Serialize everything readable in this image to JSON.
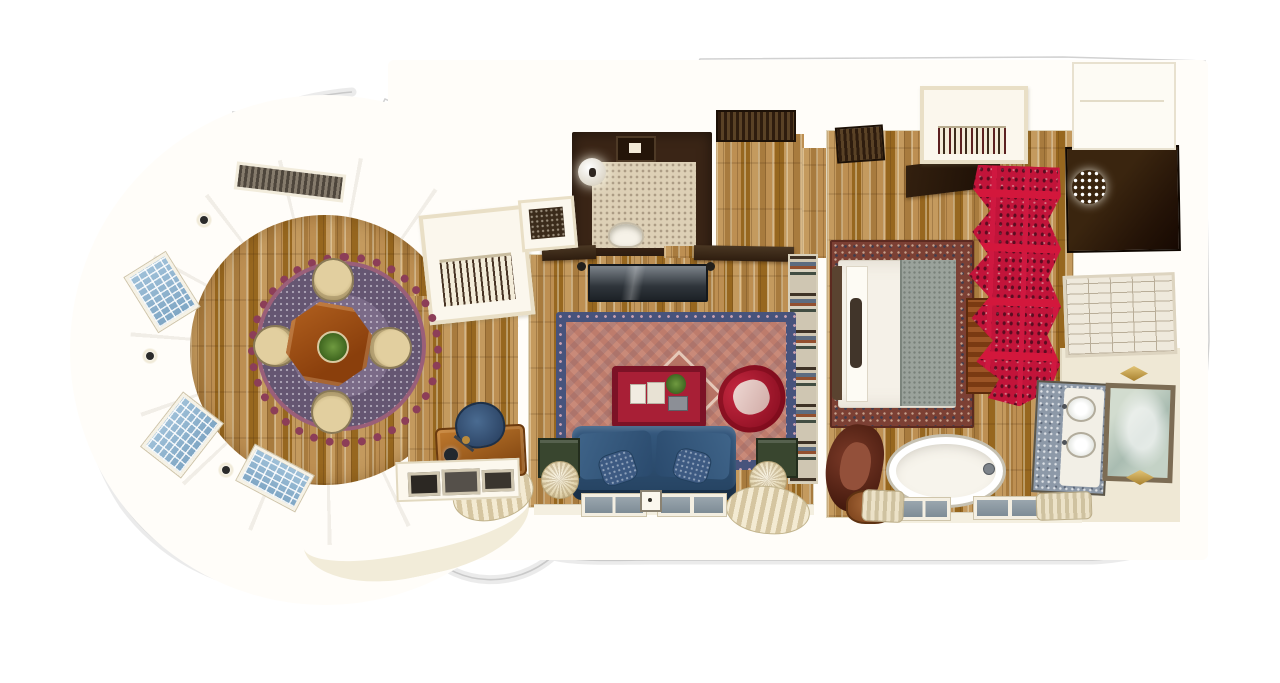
{
  "scene": {
    "kind": "hand-drawn watercolor floor plan illustration",
    "view": "top-down 3D suite plan",
    "background": "#ffffff",
    "visible_text": "none"
  },
  "palette": {
    "background": "#ffffff",
    "outline_grey": "#c9c9c9",
    "wall_cream": "#efe6cf",
    "wall_white": "#fdfbf4",
    "wood_light": "#c49a5e",
    "wood_mid": "#a87b3e",
    "wood_dark": "#7c5526",
    "dark_walnut": "#2f1d0e",
    "rug_plum": "#7b6b88",
    "rug_scallop_maroon": "#8c3e58",
    "dining_table_wood": "#9a4f16",
    "chair_cream": "#e2cf9f",
    "persian_rug_navy": "#47537c",
    "persian_rug_salmon": "#c98a79",
    "sofa_blue": "#2f4f76",
    "lacquer_red": "#a81f36",
    "armchair_red": "#9c1527",
    "screen_crimson": "#c2143a",
    "plant_green": "#55843a",
    "penny_tile_beige": "#ddd0b6",
    "subway_tile": "#efe9dc",
    "marble_blue_grey": "#8d99a8",
    "mirror_glass": "#b9c9bb",
    "gold": "#c89b45",
    "window_blue": "#8fb2cf",
    "blanket_grey": "#9aa29b",
    "leather_brown": "#5e2a1a"
  },
  "rooms": [
    {
      "id": "dining-turret",
      "name": "Round turret dining room",
      "furniture": [
        "octagonal dining table",
        "green planter centerpiece",
        "four cream tub chairs",
        "scalloped plum medallion rug",
        "top grille window",
        "three blue bay windows",
        "three wall sconces",
        "curved cream wall ring",
        "oak plank floor"
      ]
    },
    {
      "id": "hall-closet",
      "name": "Hall wardrobe",
      "furniture": [
        "hanging clothes rail",
        "shelf niche with dark luggage rack"
      ]
    },
    {
      "id": "living-room",
      "name": "Living room",
      "furniture": [
        "persian rug with navy border",
        "blue velvet sofa",
        "two paisley pillows",
        "red lacquer coffee ottoman with books and plant",
        "red scroll armchair",
        "bookshelf wall",
        "dark media console",
        "two wall speakers",
        "two green side tables",
        "two pleated ball lamps",
        "two pleated dome lamps",
        "writing desk",
        "blue desk chair",
        "desk lamp",
        "console with framed prints",
        "two bottom windows",
        "light switch",
        "two dark door lintels"
      ]
    },
    {
      "id": "powder-room",
      "name": "Powder room",
      "furniture": [
        "dark walnut walls",
        "penny tile floor",
        "globe pendant light",
        "ceiling vent",
        "pedestal sink"
      ]
    },
    {
      "id": "entry-hall",
      "name": "Entry hall",
      "furniture": [
        "dark entry door mat",
        "second dark mat",
        "dark angled canopy wall",
        "plank corridor floor"
      ]
    },
    {
      "id": "bedroom",
      "name": "Bedroom",
      "furniture": [
        "double bed with white duvet",
        "grey textured blanket at foot",
        "dark headboard",
        "pillow row",
        "dark bolster",
        "ornate red-brown bordered rug",
        "crimson scalloped paisley wardrobe screen",
        "wood tv cabinet",
        "angled television",
        "closet with hangers",
        "brown leather armchair",
        "copper ottoman"
      ]
    },
    {
      "id": "dressing-room",
      "name": "Walk-in dressing closet",
      "furniture": [
        "crystal chandelier",
        "dark walnut floor"
      ]
    },
    {
      "id": "shower-room",
      "name": "Shower",
      "furniture": [
        "white subway tile floor"
      ]
    },
    {
      "id": "bathroom",
      "name": "Bathroom",
      "furniture": [
        "freestanding white bathtub with faucet",
        "blue-grey marble double vanity",
        "two oval basins",
        "framed green-glass mirror",
        "two gold diamond sconces",
        "two bottom windows",
        "two striped bath mats",
        "linen cabinet"
      ]
    }
  ]
}
